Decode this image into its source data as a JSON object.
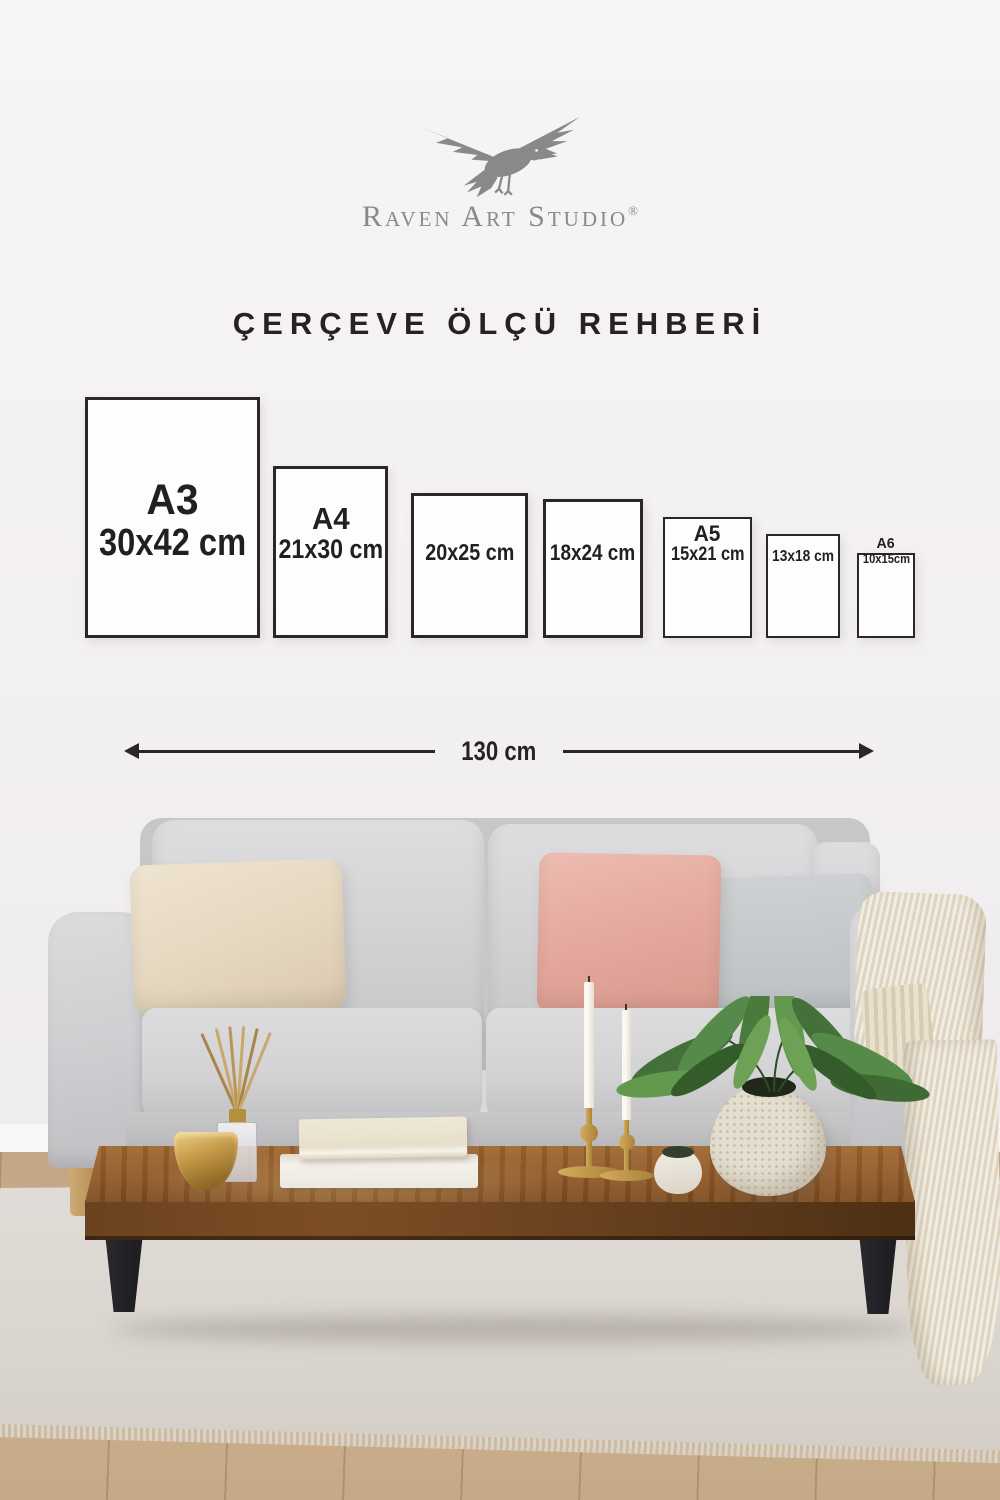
{
  "brand": {
    "name": "Raven Art Studio",
    "registered": "®",
    "logo_icon": "raven-bird",
    "color": "#8b888b"
  },
  "title": "ÇERÇEVE ÖLÇÜ REHBERİ",
  "size_guide": {
    "frames": [
      {
        "label": "A3",
        "size": "30x42 cm",
        "x": 85,
        "w": 175,
        "h": 241
      },
      {
        "label": "A4",
        "size": "21x30 cm",
        "x": 273,
        "w": 115,
        "h": 172
      },
      {
        "label": "",
        "size": "20x25 cm",
        "x": 411,
        "w": 117,
        "h": 145
      },
      {
        "label": "",
        "size": "18x24 cm",
        "x": 543,
        "w": 100,
        "h": 139
      },
      {
        "label": "A5",
        "size": "15x21 cm",
        "x": 663,
        "w": 89,
        "h": 121
      },
      {
        "label": "",
        "size": "13x18 cm",
        "x": 766,
        "w": 74,
        "h": 104
      },
      {
        "label": "A6",
        "size": "10x15cm",
        "x": 857,
        "w": 58,
        "h": 85
      }
    ],
    "baseline_y": 638,
    "sofa_width": {
      "label": "130 cm"
    }
  },
  "scene": {
    "items": [
      "sofa",
      "cream-pillow",
      "pink-pillow",
      "gray-pillow",
      "knit-throw",
      "coffee-table",
      "gold-bowl",
      "reed-diffuser",
      "book-stack",
      "brass-candlesticks",
      "white-cup",
      "speckled-vase",
      "green-plant",
      "area-rug",
      "wood-floor"
    ],
    "colors": {
      "wall": "#f4f2f3",
      "sofa": "#d6d5d7",
      "pillow_cream": "#e9decb",
      "pillow_pink": "#e2a69e",
      "pillow_gray": "#c5c8c9",
      "throw": "#ebe3d2",
      "table_wood": "#8d5828",
      "table_legs": "#232227",
      "carpet": "#dcd8d3",
      "floor": "#c9ae8e",
      "brass": "#c09a4a",
      "plant": "#4a7038",
      "frame_border": "#2b2728",
      "text": "#262223"
    }
  }
}
